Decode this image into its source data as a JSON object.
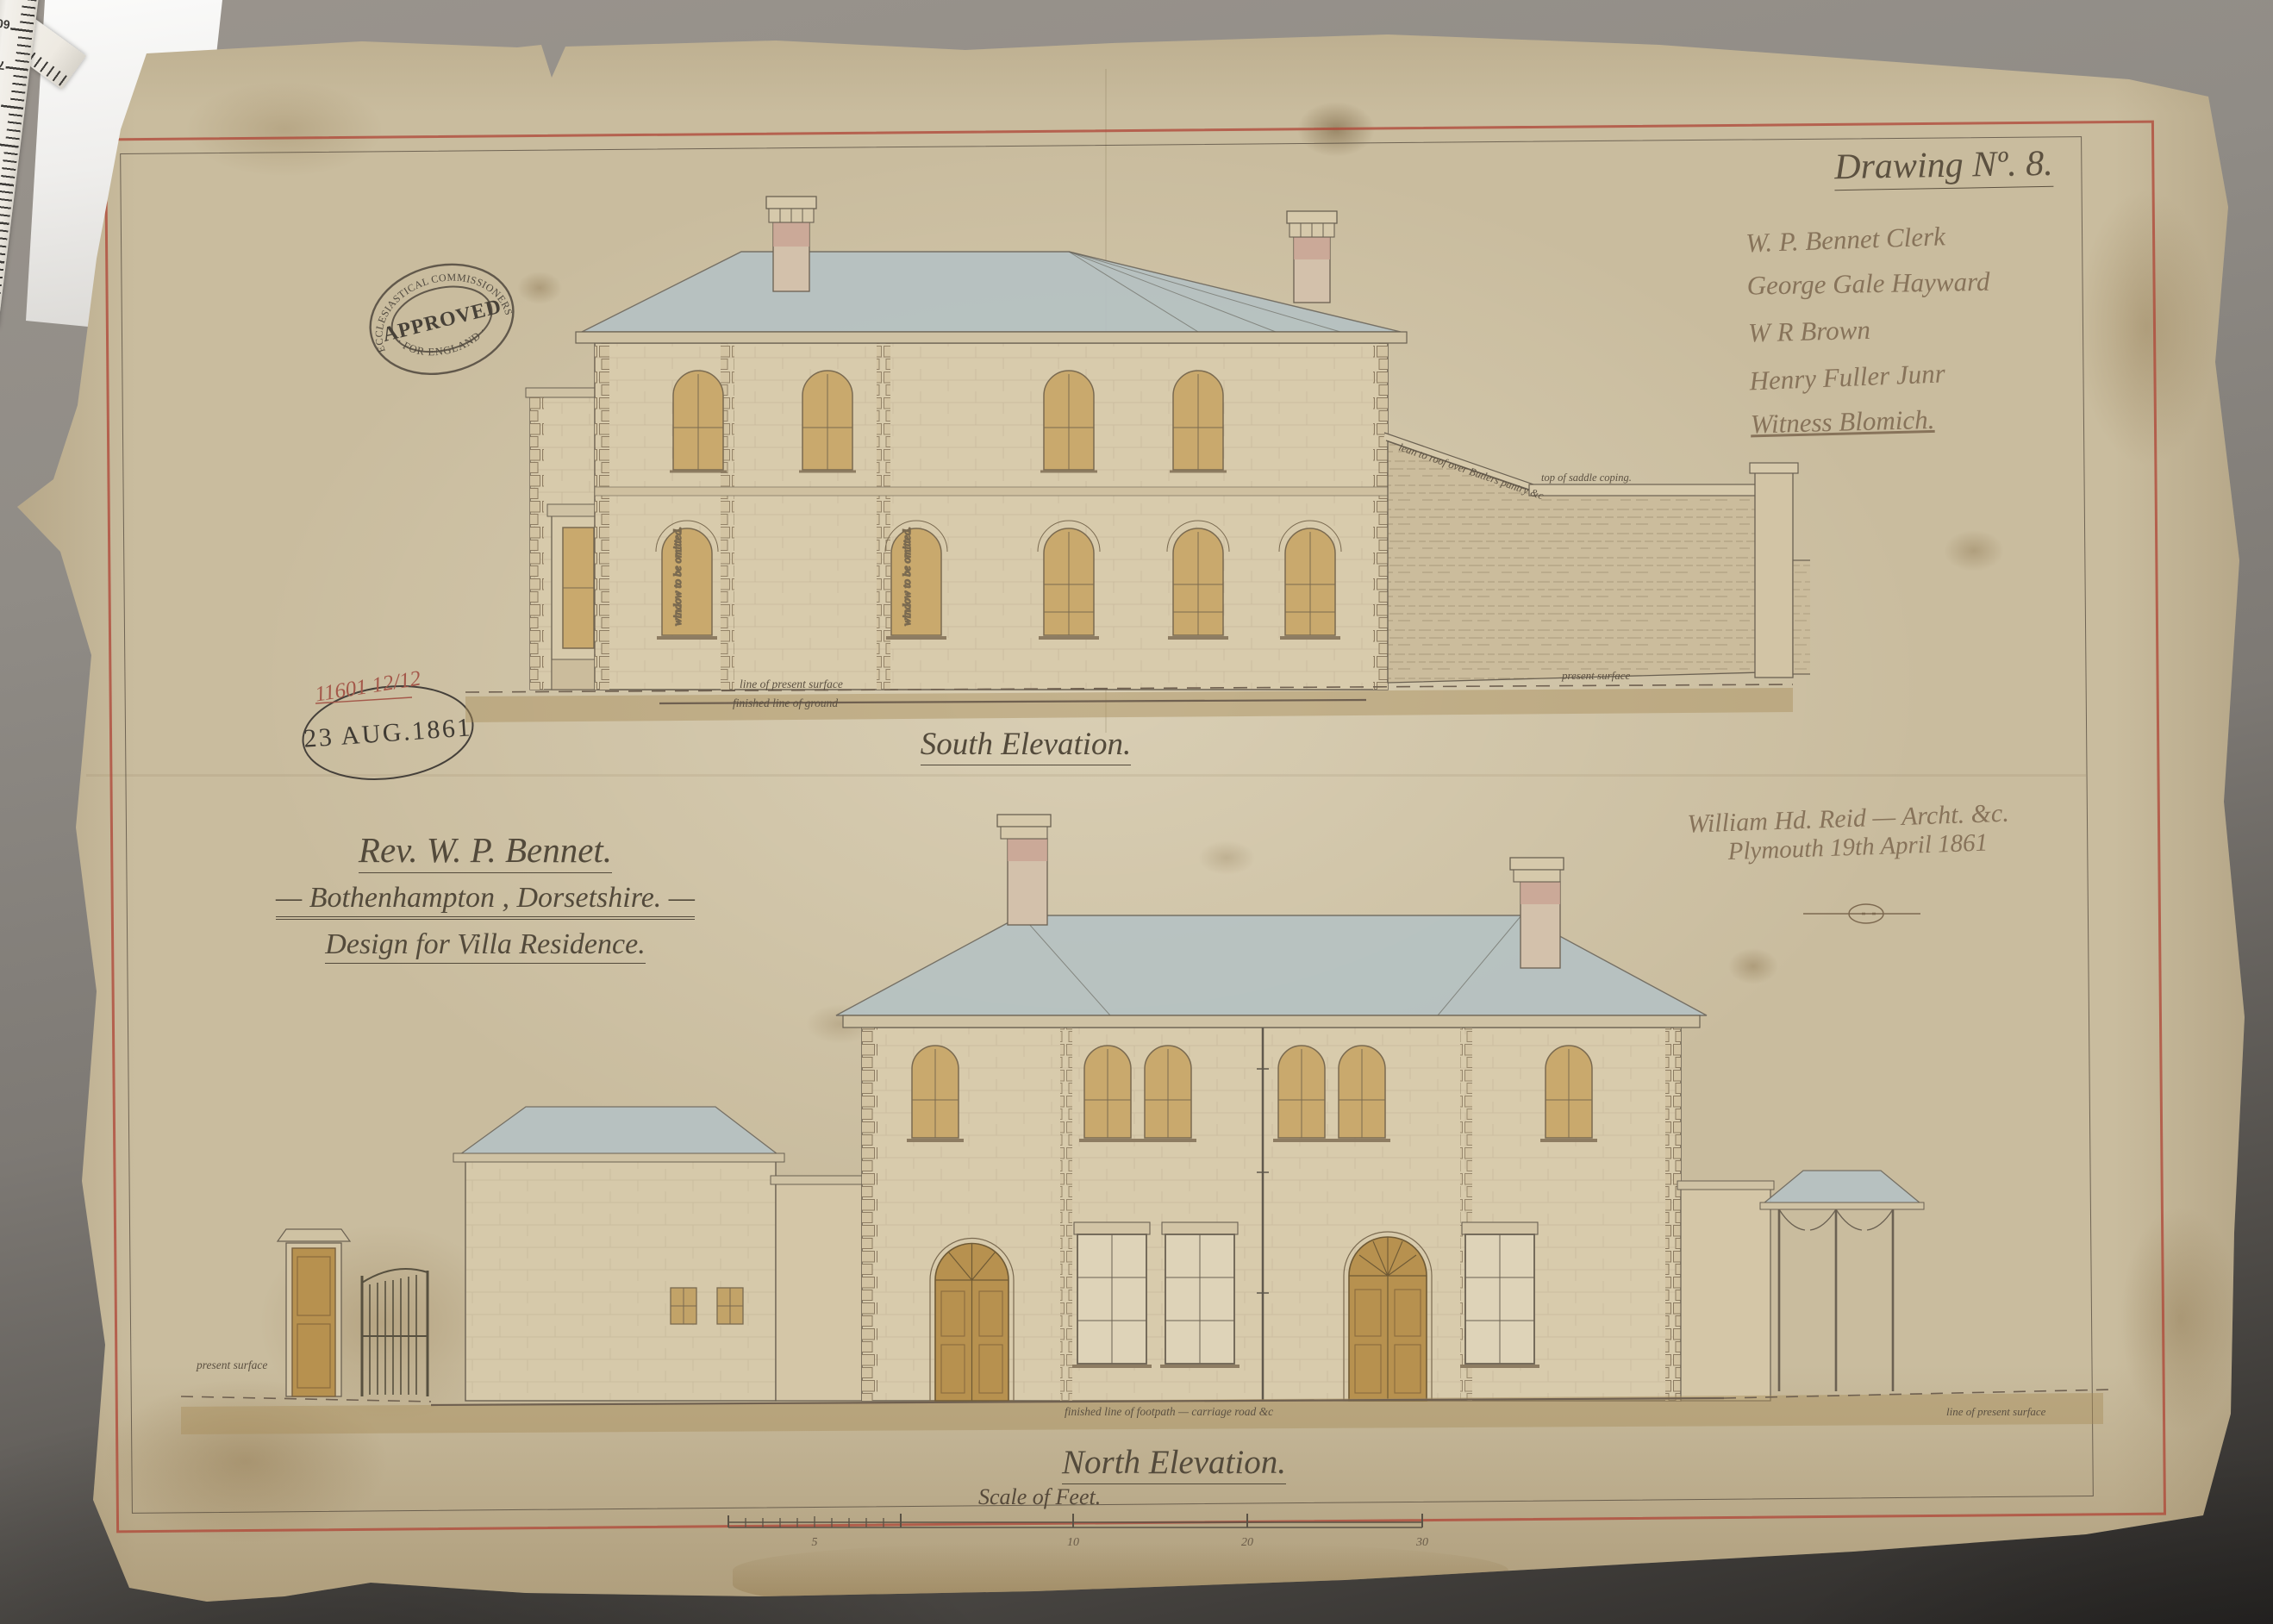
{
  "photo": {
    "ruler": {
      "numbers": [
        "60",
        "70",
        "80",
        "90",
        "100",
        "110",
        "120"
      ]
    }
  },
  "sheet": {
    "drawing_no": "Drawing Nº. 8.",
    "signatures": [
      "W. P. Bennet    Clerk",
      "George Gale Hayward",
      "W R Brown",
      "Henry Fuller Junr",
      "Witness   Blomich."
    ],
    "approval_stamp": {
      "top": "ECCLESIASTICAL COMMISSIONERS",
      "center": "APPROVED",
      "bottom": "· FOR ENGLAND ·"
    },
    "date_stamp": {
      "number": "11601 12/12",
      "date": "23 AUG.1861"
    },
    "title_block": {
      "line1": "Rev. W. P. Bennet.",
      "line2": "— Bothenhampton , Dorsetshire. —",
      "line3": "Design for Villa Residence."
    },
    "architect": {
      "line1": "William Hd. Reid — Archt. &c.",
      "line2": "Plymouth 19th April 1861"
    },
    "south": {
      "caption": "South Elevation.",
      "ann": {
        "lean_to": "lean to roof over Butlers pantry &c",
        "coping": "top of saddle coping.",
        "omit": "window to be omitted.",
        "present": "line of present surface",
        "finished": "finished line of ground",
        "surface_right": "present surface"
      }
    },
    "north": {
      "caption": "North Elevation.",
      "ann": {
        "surface_left": "present surface",
        "footpath": "finished line of footpath — carriage road &c",
        "surface_right": "line of present surface"
      }
    },
    "scale": {
      "label": "Scale of Feet.",
      "ticks": [
        "5",
        "10",
        "20",
        "30"
      ]
    }
  }
}
